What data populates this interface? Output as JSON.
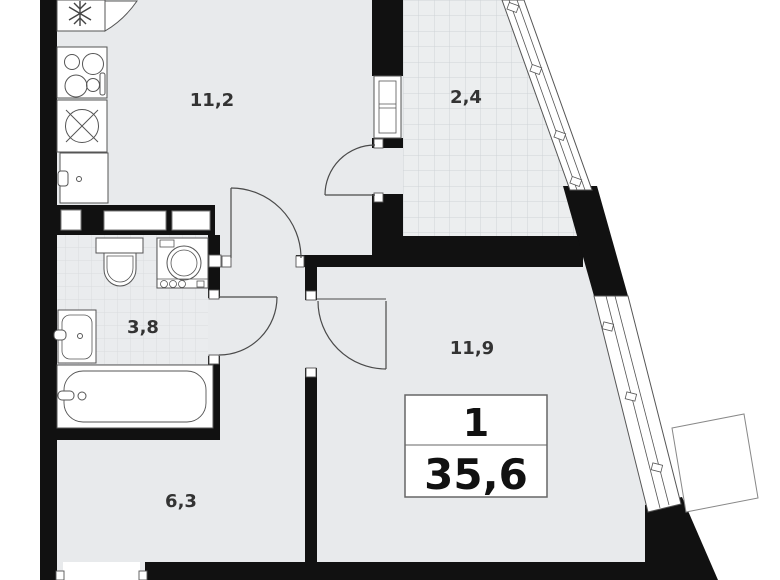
{
  "plan": {
    "title": "apartment-floor-plan",
    "info_box": {
      "rooms_count": "1",
      "total_area": "35,6"
    },
    "rooms": [
      {
        "key": "kitchen",
        "area": "11,2"
      },
      {
        "key": "balcony",
        "area": "2,4"
      },
      {
        "key": "bathroom",
        "area": "3,8"
      },
      {
        "key": "living-room",
        "area": "11,9"
      },
      {
        "key": "hallway",
        "area": "6,3"
      }
    ],
    "fixtures": [
      "fridge-snowflake",
      "stove-4-burners",
      "kitchen-sink",
      "kitchen-cabinet",
      "toilet",
      "washing-machine",
      "bathroom-sink",
      "bathtub",
      "balcony-glazing",
      "window",
      "ac-basket"
    ],
    "colors": {
      "wall": "#111111",
      "floor": "#e8eaec",
      "outline": "#555555",
      "label": "#333333",
      "tile_line": "#d3d7da",
      "outside": "#ffffff"
    }
  }
}
